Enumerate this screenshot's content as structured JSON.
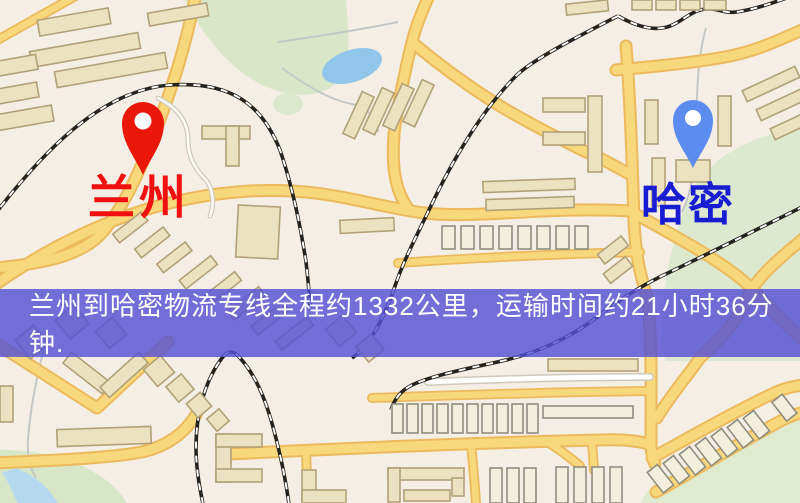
{
  "banner": {
    "text": "兰州到哈密物流专线全程约1332公里，运输时间约21小时36分钟.",
    "background_rgba": "rgba(86,80,212,0.82)",
    "background_color": "#5650d4",
    "text_color": "#ffffff"
  },
  "markers": {
    "origin": {
      "label": "兰州",
      "pin_color": "#ea1607",
      "label_color": "#f01010"
    },
    "destination": {
      "label": "哈密",
      "pin_color": "#5c8cf0",
      "label_color": "#191dd2"
    }
  },
  "route_info": {
    "origin": "兰州",
    "destination": "哈密",
    "distance_text": "约1332公里",
    "duration_text": "约21小时36分钟"
  },
  "map_colors": {
    "background": "#f4eee4",
    "road_yellow": "#f8d87c",
    "park_green": "#d9e7c8",
    "lake_blue": "#8fc6ea",
    "railway": "#26241f"
  }
}
